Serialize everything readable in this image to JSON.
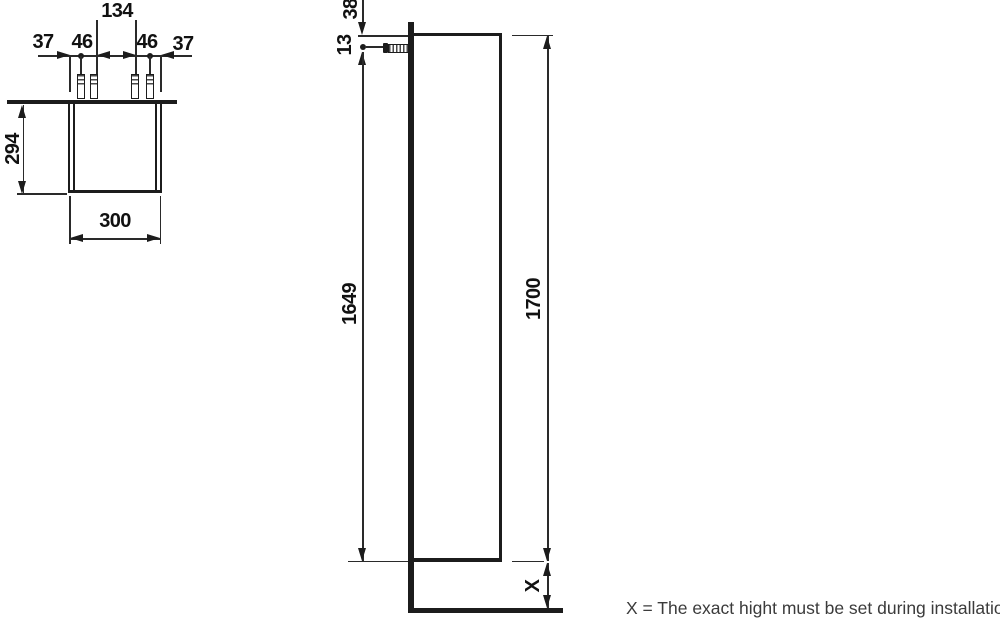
{
  "top_view": {
    "dims": {
      "edge_left": "37",
      "screw_offset_left": "46",
      "screw_span": "134",
      "screw_offset_right": "46",
      "edge_right": "37",
      "depth": "294",
      "width": "300"
    }
  },
  "side_view": {
    "dims": {
      "top_offset": "38",
      "screw_inset": "13",
      "screw_height": "1649",
      "cabinet_height": "1700",
      "floor_gap": "X"
    }
  },
  "caption": "X = The exact hight must be set during installation."
}
